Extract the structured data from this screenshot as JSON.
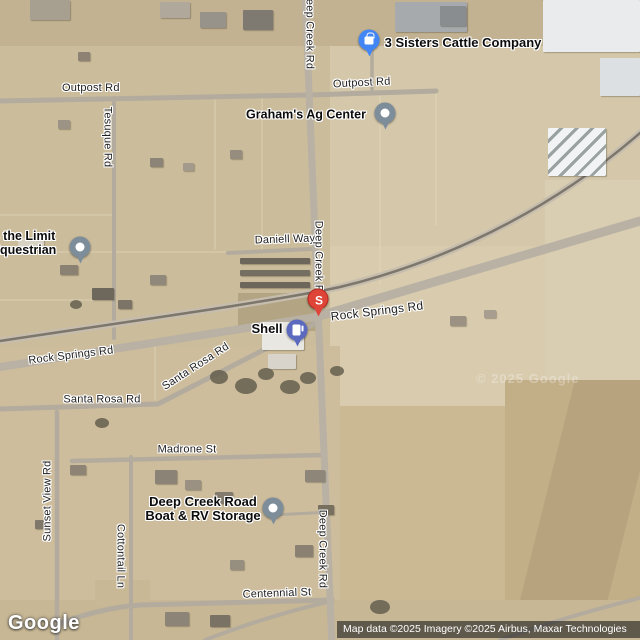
{
  "map": {
    "watermark": "© 2025 Google",
    "roads": {
      "outpost_west": "Outpost Rd",
      "outpost_east": "Outpost Rd",
      "tesuque": "Tesuque Rd",
      "daniell": "Daniell Way",
      "deep_creek_top": "Deep Creek Rd",
      "deep_creek_mid": "Deep Creek Rd",
      "deep_creek_bottom": "Deep Creek Rd",
      "rock_springs_east": "Rock Springs Rd",
      "rock_springs_west": "Rock Springs Rd",
      "santa_rosa_diagonal": "Santa Rosa Rd",
      "santa_rosa_west": "Santa Rosa Rd",
      "madrone": "Madrone St",
      "sunset_view": "Sunset View Rd",
      "cottontail": "Cottontail Ln",
      "centennial": "Centennial St"
    },
    "pois": {
      "three_sisters": {
        "label": "3 Sisters Cattle Company",
        "marker_color": "#4285F4"
      },
      "grahams": {
        "label": "Graham's Ag Center",
        "marker_color": "#7E8D9A"
      },
      "equestrian": {
        "line1": "s the Limit",
        "line2": "Equestrian",
        "marker_color": "#7E8D9A"
      },
      "shell": {
        "label": "Shell",
        "marker_color": "#5B6ABF"
      },
      "storage": {
        "line1": "Deep Creek Road",
        "line2": "Boat & RV Storage",
        "marker_color": "#7E8D9A"
      },
      "s_pin": {
        "label": "S",
        "marker_color": "#DE4437"
      }
    }
  },
  "footer": {
    "logo": "Google",
    "attribution": "Map data ©2025 Imagery ©2025 Airbus, Maxar Technologies"
  }
}
